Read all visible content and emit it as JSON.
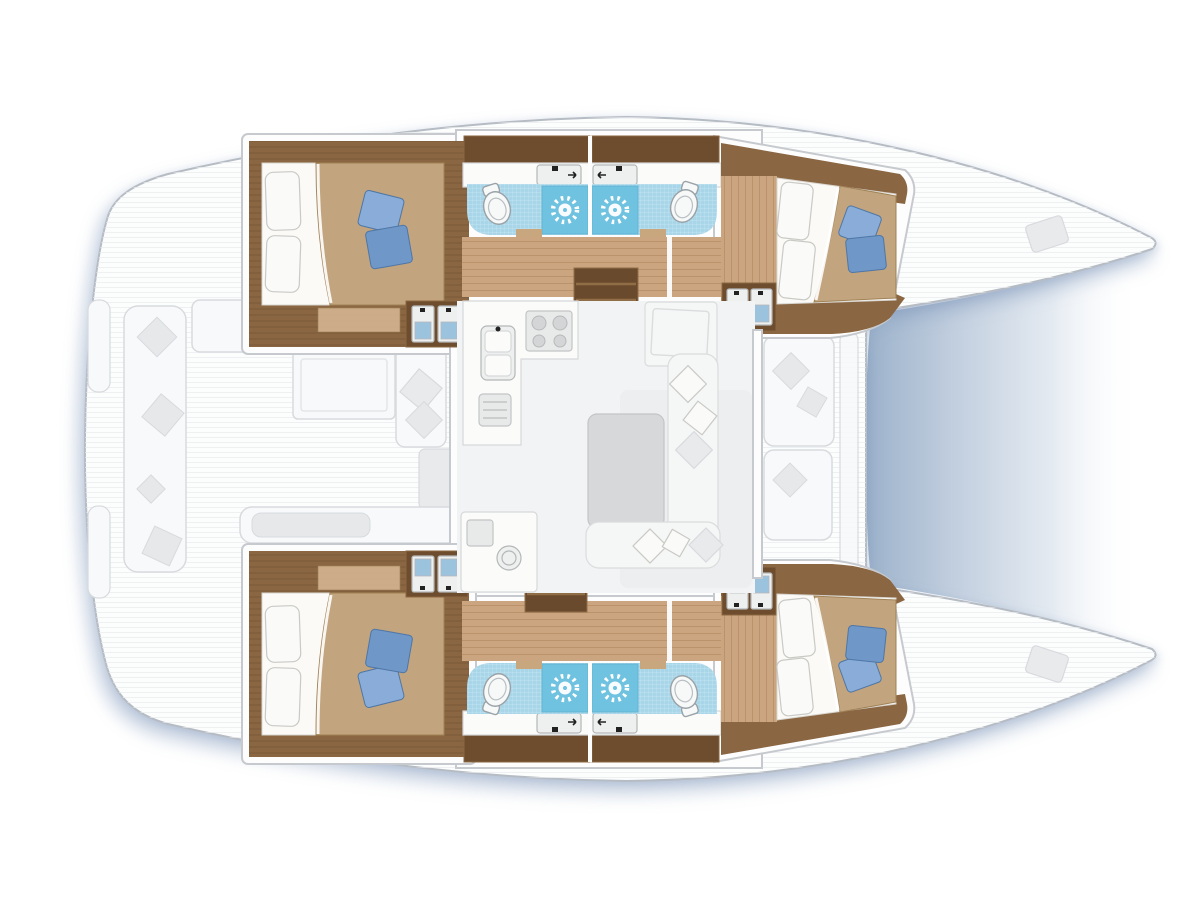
{
  "page": {
    "background": "#ffffff",
    "subject": "catamaran-deck-and-interior-floor-plan",
    "orientation": "bow-right"
  },
  "inventory": {
    "hulls": 2,
    "double_cabins": 4,
    "bathrooms": 4,
    "toilets": 4,
    "showers": 4,
    "bathroom_sink_counters": 4,
    "cabin_vanity_basins": 8,
    "galley_burners": 4,
    "galley_sink_basins": 2,
    "wet_bar_round_sink": 1,
    "hull_stairways": 2,
    "salon_table": 1,
    "cockpit_benches": 3,
    "foredeck_benches": 2,
    "trampoline": 1
  },
  "colors": {
    "hull_fill": "#fcfdfd",
    "hull_stroke": "#b6bcc4",
    "shadow_color": "#7d94b8",
    "deck_line": "#e8eaec",
    "deck_fill": "#f8f9fa",
    "deck_stroke": "#d8dbde",
    "deck_pillow": "#e6e8ea",
    "deck_seat": "#e9eaec",
    "wall_fill": "#fdfdfd",
    "wall_stroke": "#c6cace",
    "wood_dark": "#8a6642",
    "wood_cabinet": "#6e4d2e",
    "wood_floor": "#cba580",
    "wood_floor_line": "#aa8058",
    "rug": "#d4b491",
    "stairs_fill": "#6a4a2c",
    "stairs_line": "#8f6d47",
    "bed_sheet": "#fbfaf7",
    "bed_stroke": "#d8d5cf",
    "blanket": "#c2a47e",
    "blanket_edge": "#a08257",
    "pillow_white": "#fafaf9",
    "pillow_white_stroke": "#c9c9c5",
    "pillow_blue": "#6f97c7",
    "pillow_blue2": "#89add8",
    "pillow_blue_stroke": "#4e76a6",
    "tile": "#a8d5e8",
    "tile_shower": "#6fc2e0",
    "tile_line": "rgba(255,255,255,0.45)",
    "porcelain": "#f7f8f8",
    "porcelain_stroke": "#9aa2a7",
    "counter": "#fbfbfa",
    "counter_stroke": "#d6d8d9",
    "basin": "#eef0f0",
    "basin_stroke": "#b4b7b8",
    "faucet": "#222222",
    "appliance": "#e8eaea",
    "appliance_stroke": "#c2c4c5",
    "burner": "#d3d5d6",
    "burner_stroke": "#b7b9ba",
    "table": "#d6d8da",
    "table_stroke": "#c2c4c6",
    "sofa": "#f5f6f6",
    "sofa_stroke": "#dadcdd",
    "salon_floor": "#f2f3f4",
    "salon_shade": "#e9ebed",
    "door_mark": "#c9a77e",
    "sink_blue": "#9cc3de",
    "tramp_deep": "#9cb2cb",
    "tramp_mid": "#c2cfdf",
    "tramp_faint": "rgba(255,255,255,0)"
  }
}
